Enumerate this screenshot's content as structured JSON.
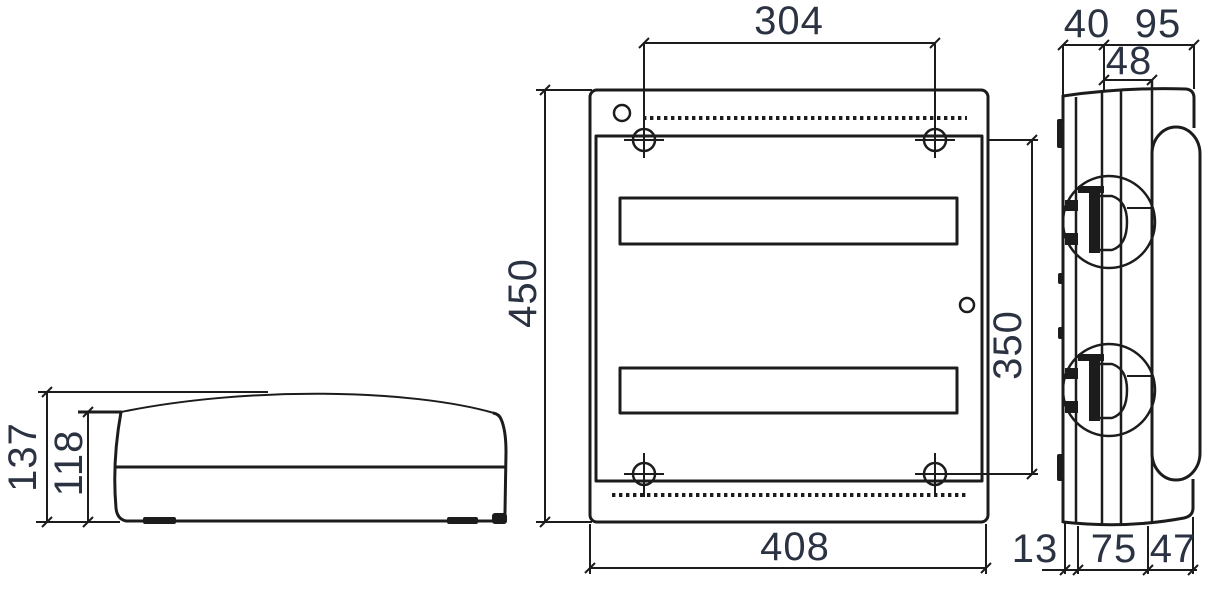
{
  "colors": {
    "line": "#1c1c1c",
    "dimension_text": "#2b3342",
    "background": "#ffffff"
  },
  "dimensions": {
    "front_hole_spacing_horizontal": "304",
    "front_overall_height": "450",
    "front_hole_spacing_vertical": "350",
    "front_overall_width": "408",
    "side_back_depth": "40",
    "side_front_depth": "95",
    "side_rail_depth": "48",
    "side_bottom_back": "13",
    "side_bottom_body": "75",
    "side_bottom_front": "47",
    "top_overall_depth": "137",
    "top_body_depth": "118"
  }
}
